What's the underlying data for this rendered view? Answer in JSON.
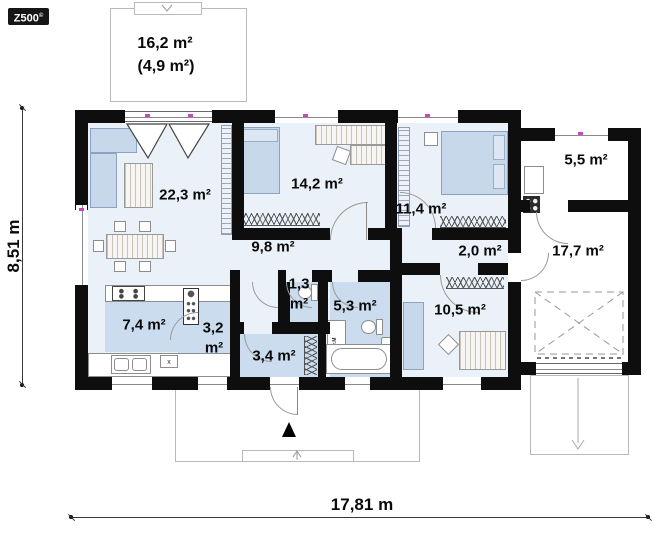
{
  "logo": {
    "brand": "Z500",
    "mark": "©"
  },
  "plan": {
    "terrace": {
      "area": "16,2 m²",
      "area_secondary": "(4,9 m²)"
    },
    "rooms": [
      {
        "name": "living-room",
        "area": "22,3 m²"
      },
      {
        "name": "bedroom-1",
        "area": "14,2 m²"
      },
      {
        "name": "bedroom-2",
        "area": "11,4 m²"
      },
      {
        "name": "hall",
        "area": "9,8 m²"
      },
      {
        "name": "corridor",
        "area": "2,0 m²"
      },
      {
        "name": "utility-room",
        "area": "5,5 m²"
      },
      {
        "name": "garage",
        "area": "17,7 m²"
      },
      {
        "name": "kitchen",
        "area": "7,4 m²"
      },
      {
        "name": "pantry",
        "area_line1": "3,2",
        "area_line2": "m²"
      },
      {
        "name": "wc",
        "area_line1": "1,3",
        "area_line2": "m²"
      },
      {
        "name": "bathroom",
        "area": "5,3 m²"
      },
      {
        "name": "vestibule",
        "area": "3,4 m²"
      },
      {
        "name": "office",
        "area": "10,5 m²"
      }
    ],
    "appliances": {
      "washer_label": "Cr.M",
      "kitchen_box_label": "x"
    },
    "dimensions": {
      "total_width": "17,81 m",
      "total_height": "8,51 m"
    },
    "colors": {
      "wall": "#0e0e0e",
      "floor_light": "#ebf1f8",
      "floor_blue": "#cbdcee",
      "furniture": "#c6d8ea",
      "window_tick": "#cc44cc"
    }
  }
}
